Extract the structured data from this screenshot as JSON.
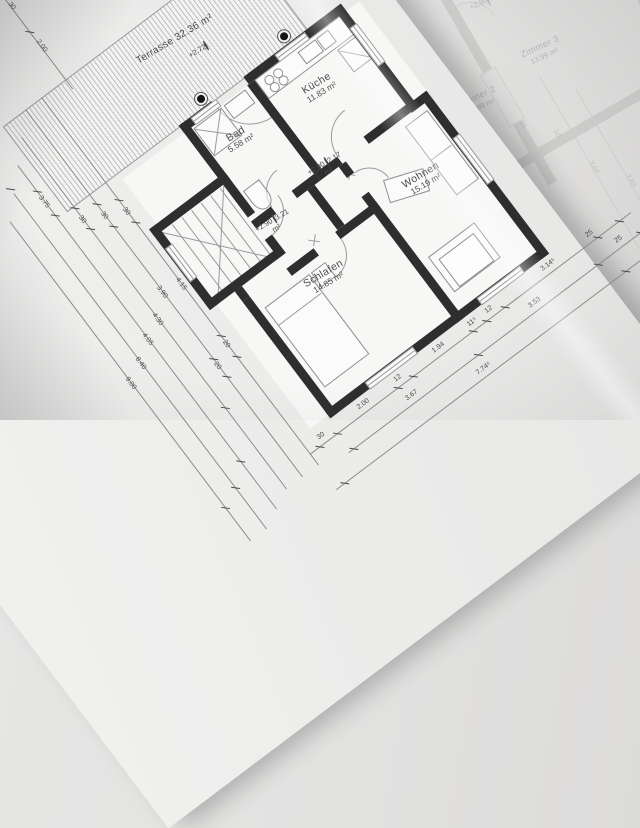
{
  "sheet1": {
    "rooms": {
      "terrasse": {
        "label": "Terrasse",
        "area": "32.36 m²",
        "level": "+2.72"
      },
      "kueche": {
        "label": "Küche",
        "area": "11.83 m²"
      },
      "bad": {
        "label": "Bad",
        "area": "5.58 m²"
      },
      "flur": {
        "area": "3.21 m²",
        "level": "+2.90"
      },
      "diele": {
        "area": "2.17 m²",
        "level": "+2.90"
      },
      "wohnen": {
        "label": "Wohnen",
        "area": "15.19 m²"
      },
      "schlafen": {
        "label": "Schlafen",
        "area": "14.85 m²"
      }
    },
    "dims": {
      "west": [
        "30",
        "4.15",
        "20",
        "30",
        "3.90",
        "20",
        "30",
        "4.30",
        "3.75",
        "4.05",
        "8.40",
        "9.00",
        "2.00",
        "30"
      ],
      "south": [
        "30",
        "2.00",
        "12",
        "1.94",
        "11⁵",
        "12",
        "3.14⁵",
        "25",
        "3.67",
        "3.53",
        "25",
        "7.74⁵"
      ]
    }
  },
  "sheet2": {
    "rooms": {
      "zimmer1": {
        "label": "Zimmer 1",
        "area": "11.39 m²"
      },
      "zimmer2": {
        "label": "Zimmer 2",
        "area": "12.98 m²"
      },
      "zimmer3": {
        "label": "Zimmer 3",
        "area": "13.99 m²"
      }
    },
    "level": "+2.90",
    "dims": [
      "3.02",
      "3.02",
      "10",
      "10"
    ]
  },
  "icons": {
    "level_marker": "half-filled-circle",
    "drain_knob": "filled-circle-with-ring"
  },
  "colors": {
    "wall": "#2e2e2e",
    "paper": "#f1f1f0",
    "ink": "#4c4c4c",
    "faded_ink": "#aeaeae"
  }
}
